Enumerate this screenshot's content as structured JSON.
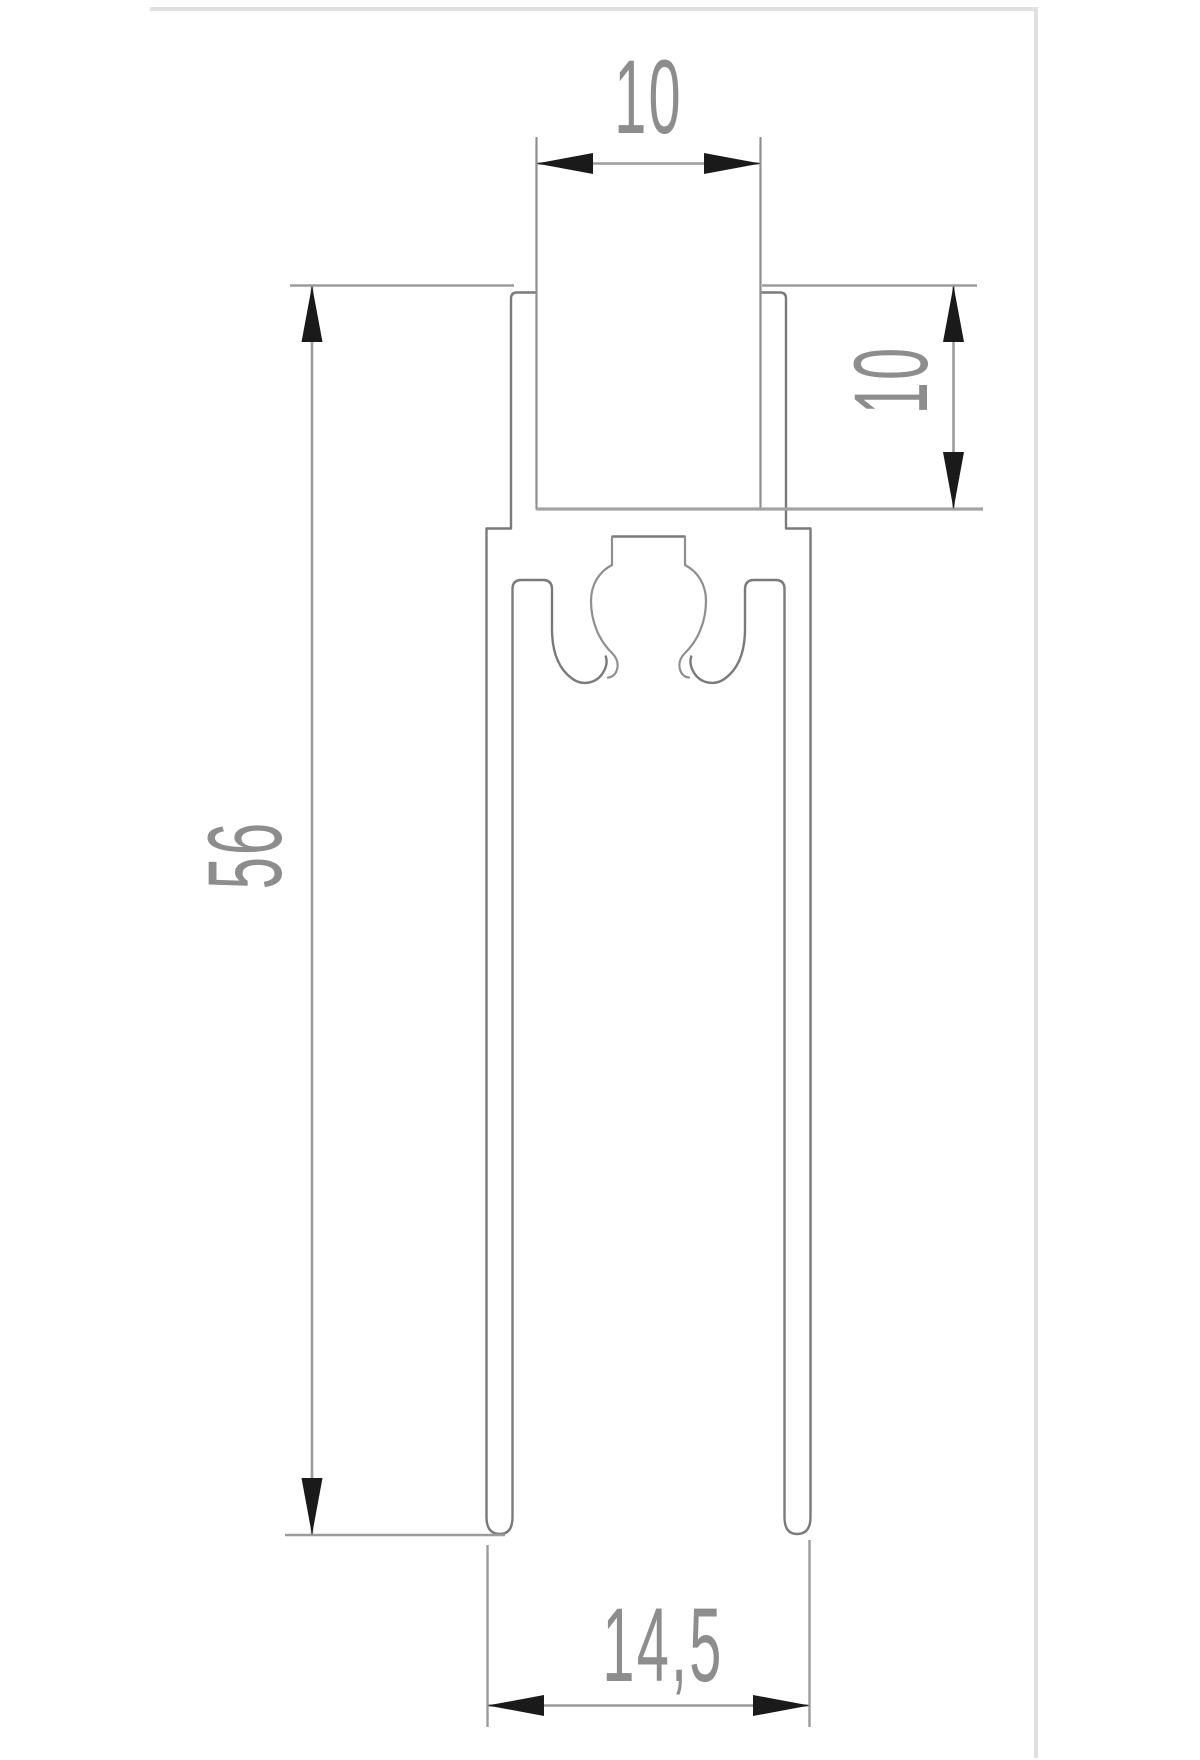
{
  "drawing": {
    "description": "Technical drawing: cross-section of an aluminium extrusion profile (top screw slot, two legs, central screw port) with four dimensions",
    "dimensions": {
      "slot_width": {
        "label": "10",
        "orientation": "horizontal",
        "location": "top"
      },
      "slot_depth": {
        "label": "10",
        "orientation": "vertical",
        "location": "right"
      },
      "profile_height": {
        "label": "56",
        "orientation": "vertical",
        "location": "left"
      },
      "overall_width": {
        "label": "14,5",
        "orientation": "horizontal",
        "location": "bottom"
      }
    },
    "colors": {
      "background": "#ffffff",
      "outline": "#7a7a7a",
      "outline_light": "#8f8f8f",
      "dimension_line": "#9c9c9c",
      "arrow": "#1a1a1a",
      "label_text": "#8d8d8d",
      "sheet_frame": "#e0e0e0"
    }
  }
}
